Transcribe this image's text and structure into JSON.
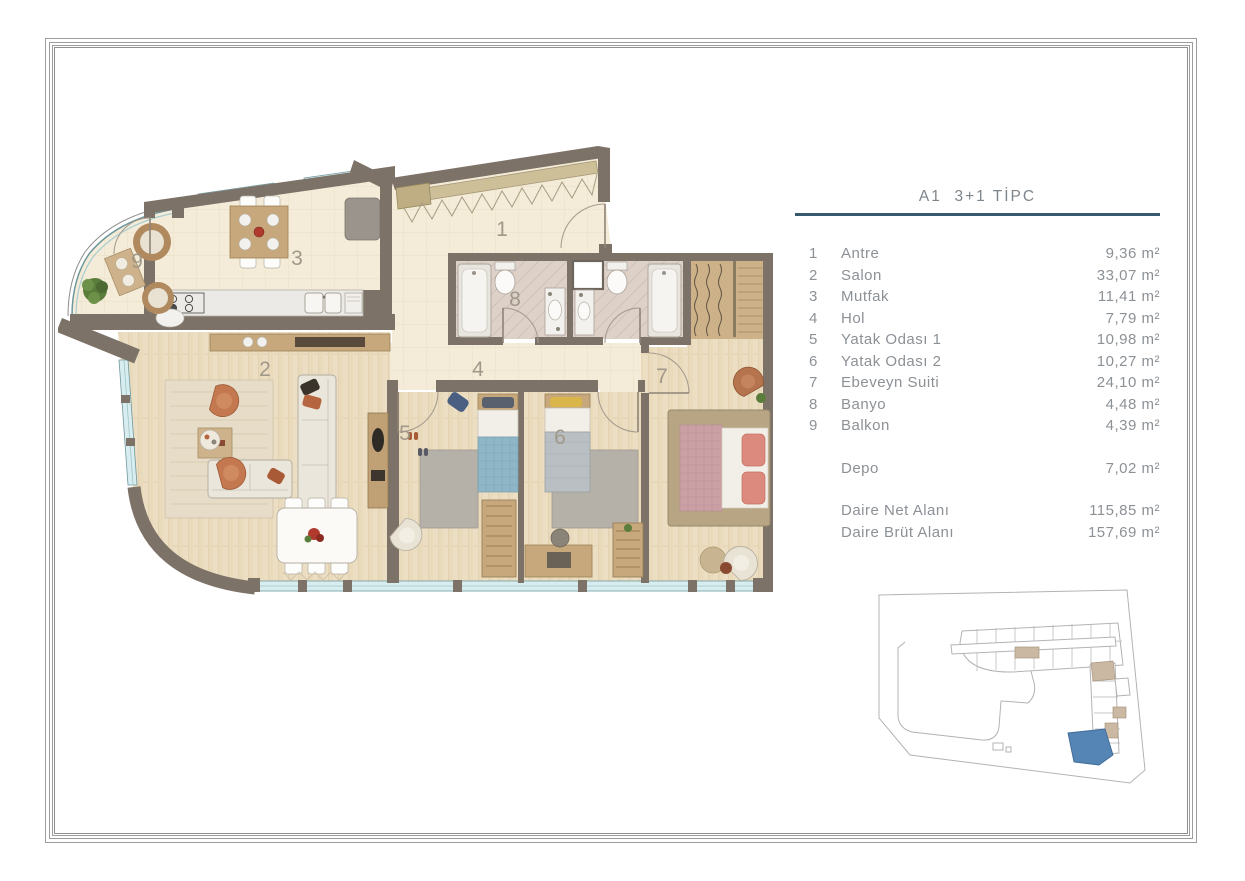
{
  "legend": {
    "title": "A1  3+1 TİPC",
    "rows": [
      {
        "no": "1",
        "name": "Antre",
        "area": "9,36 m²"
      },
      {
        "no": "2",
        "name": "Salon",
        "area": "33,07 m²"
      },
      {
        "no": "3",
        "name": "Mutfak",
        "area": "11,41 m²"
      },
      {
        "no": "4",
        "name": "Hol",
        "area": "7,79 m²"
      },
      {
        "no": "5",
        "name": "Yatak Odası 1",
        "area": "10,98 m²"
      },
      {
        "no": "6",
        "name": "Yatak Odası 2",
        "area": "10,27 m²"
      },
      {
        "no": "7",
        "name": "Ebeveyn Suiti",
        "area": "24,10 m²"
      },
      {
        "no": "8",
        "name": "Banyo",
        "area": "4,48 m²"
      },
      {
        "no": "9",
        "name": "Balkon",
        "area": "4,39 m²"
      }
    ],
    "storage_row": {
      "no": "",
      "name": "Depo",
      "area": "7,02 m²"
    },
    "totals": [
      {
        "name": "Daire Net Alanı",
        "area": "115,85 m²"
      },
      {
        "name": "Daire Brüt Alanı",
        "area": "157,69 m²"
      }
    ]
  },
  "colors": {
    "wall": "#7d7267",
    "tile_floor": "#f4ecd9",
    "wood_floor": "#ecdec2",
    "bath_tile": "#ddd1c8",
    "window_glass": "#d8edef",
    "window_frame": "#6f989e",
    "legend_rule": "#38586c",
    "legend_text": "#8c9196",
    "keyplan_highlight": "#5585b5",
    "keyplan_unit_beige": "#cbb8a2"
  }
}
